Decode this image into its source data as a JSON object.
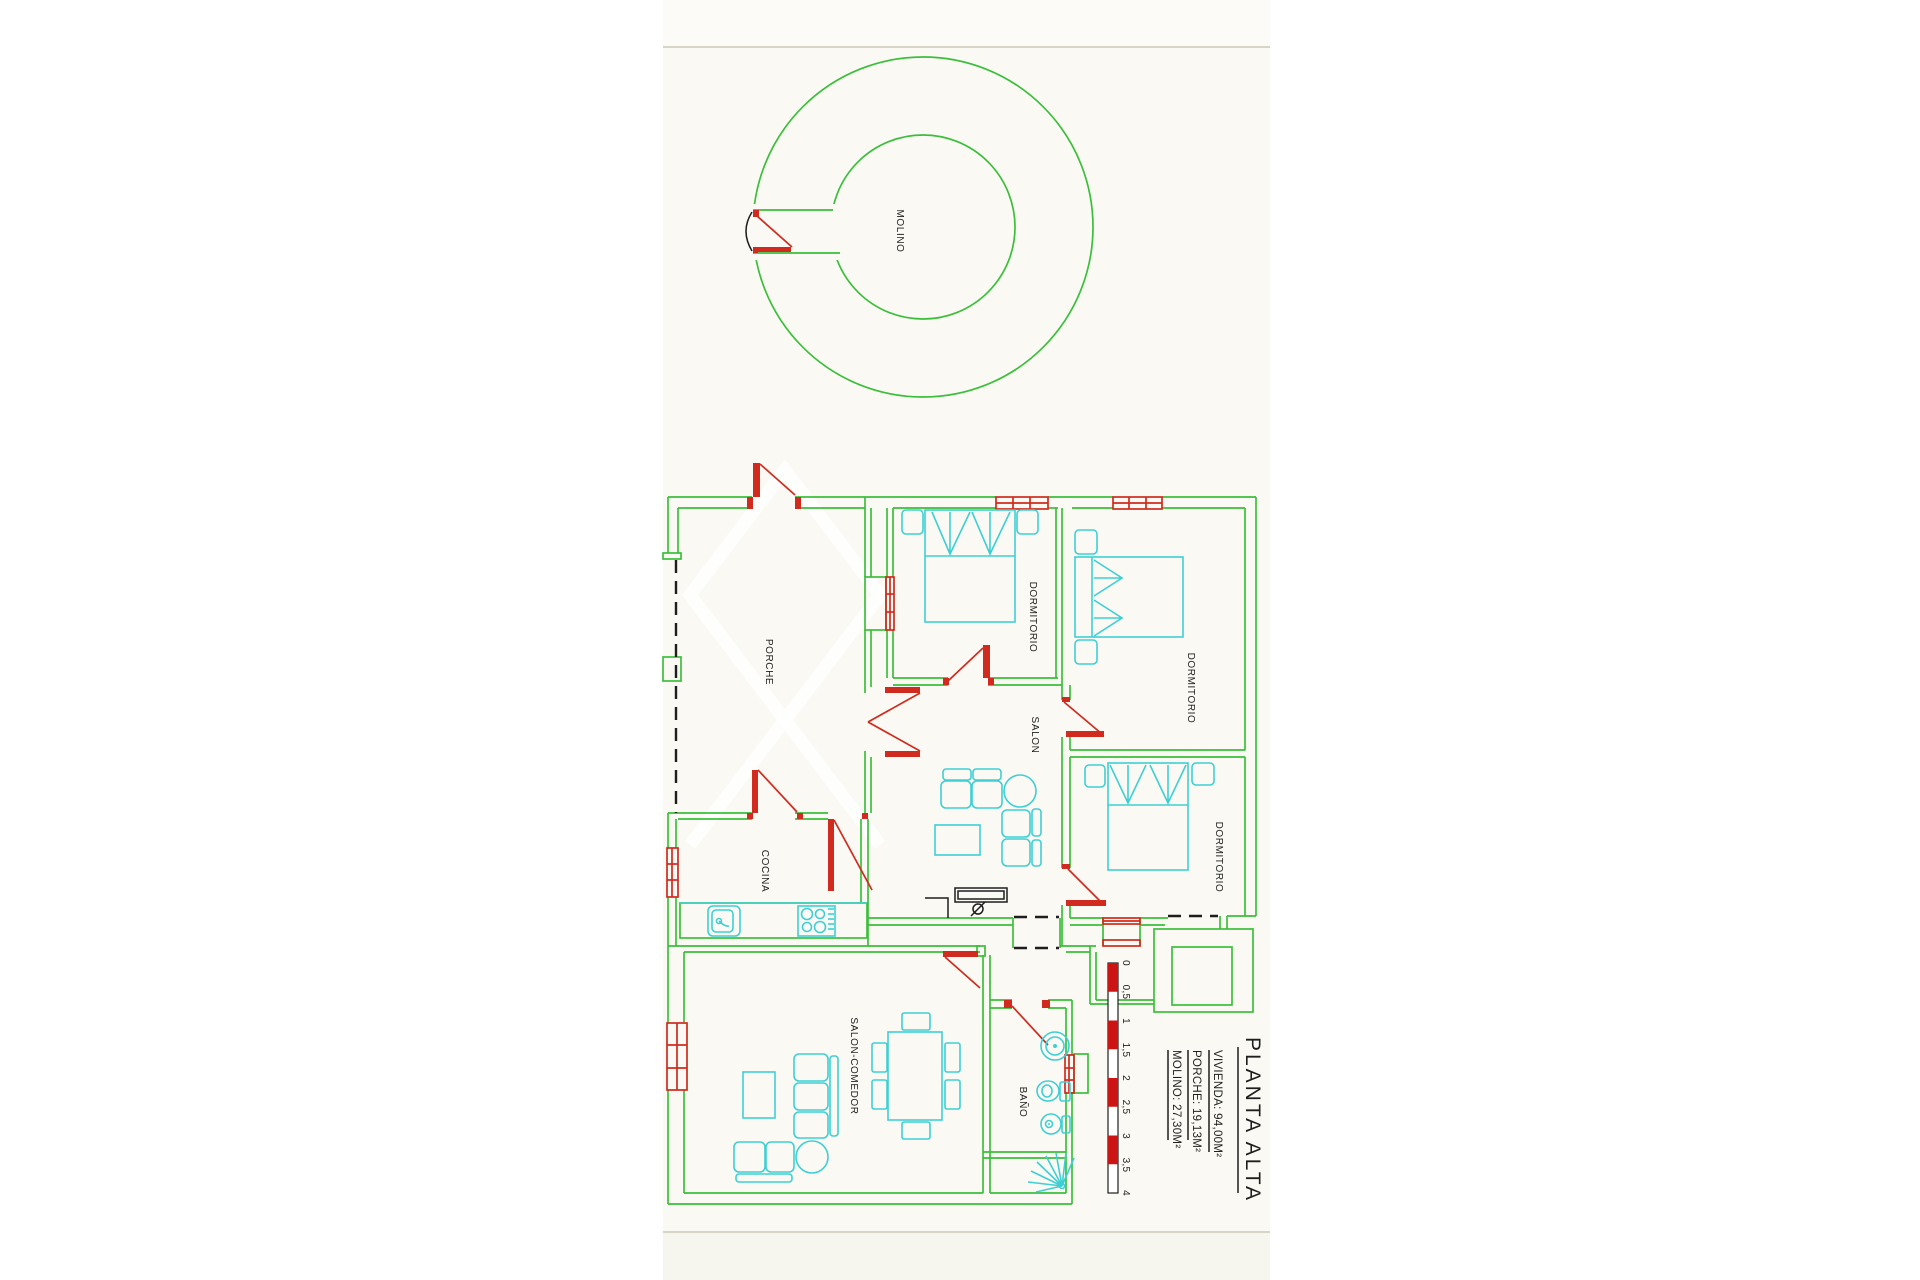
{
  "sheet": {
    "background": "#faf9f4",
    "top_band": "#fcfbf7",
    "bottom_band": "#f6f5ee",
    "edge_line_color": "#d9d5c6"
  },
  "palette": {
    "wall_green": "#3bbf3b",
    "accent_red": "#d02b1e",
    "furniture_cyan": "#3ecfd4",
    "ink_black": "#1e1e1e",
    "scale_red": "#cc1414",
    "scale_white": "#ffffff"
  },
  "plan": {
    "rooms": {
      "molino": "MOLINO",
      "porche": "PORCHE",
      "dormitorio": "DORMITORIO",
      "salon": "SALON",
      "cocina": "COCINA",
      "salon_comedor": "SALON-COMEDOR",
      "bano": "BAÑO"
    }
  },
  "scale_bar": {
    "ticks": [
      "0",
      "0,5",
      "1",
      "1,5",
      "2",
      "2,5",
      "3",
      "3,5",
      "4"
    ]
  },
  "title_block": {
    "title": "PLANTA ALTA",
    "areas": [
      {
        "label": "VIVIENDA: 94,00M²"
      },
      {
        "label": "PORCHE: 19,13M²"
      },
      {
        "label": "MOLINO: 27,30M²"
      }
    ]
  }
}
